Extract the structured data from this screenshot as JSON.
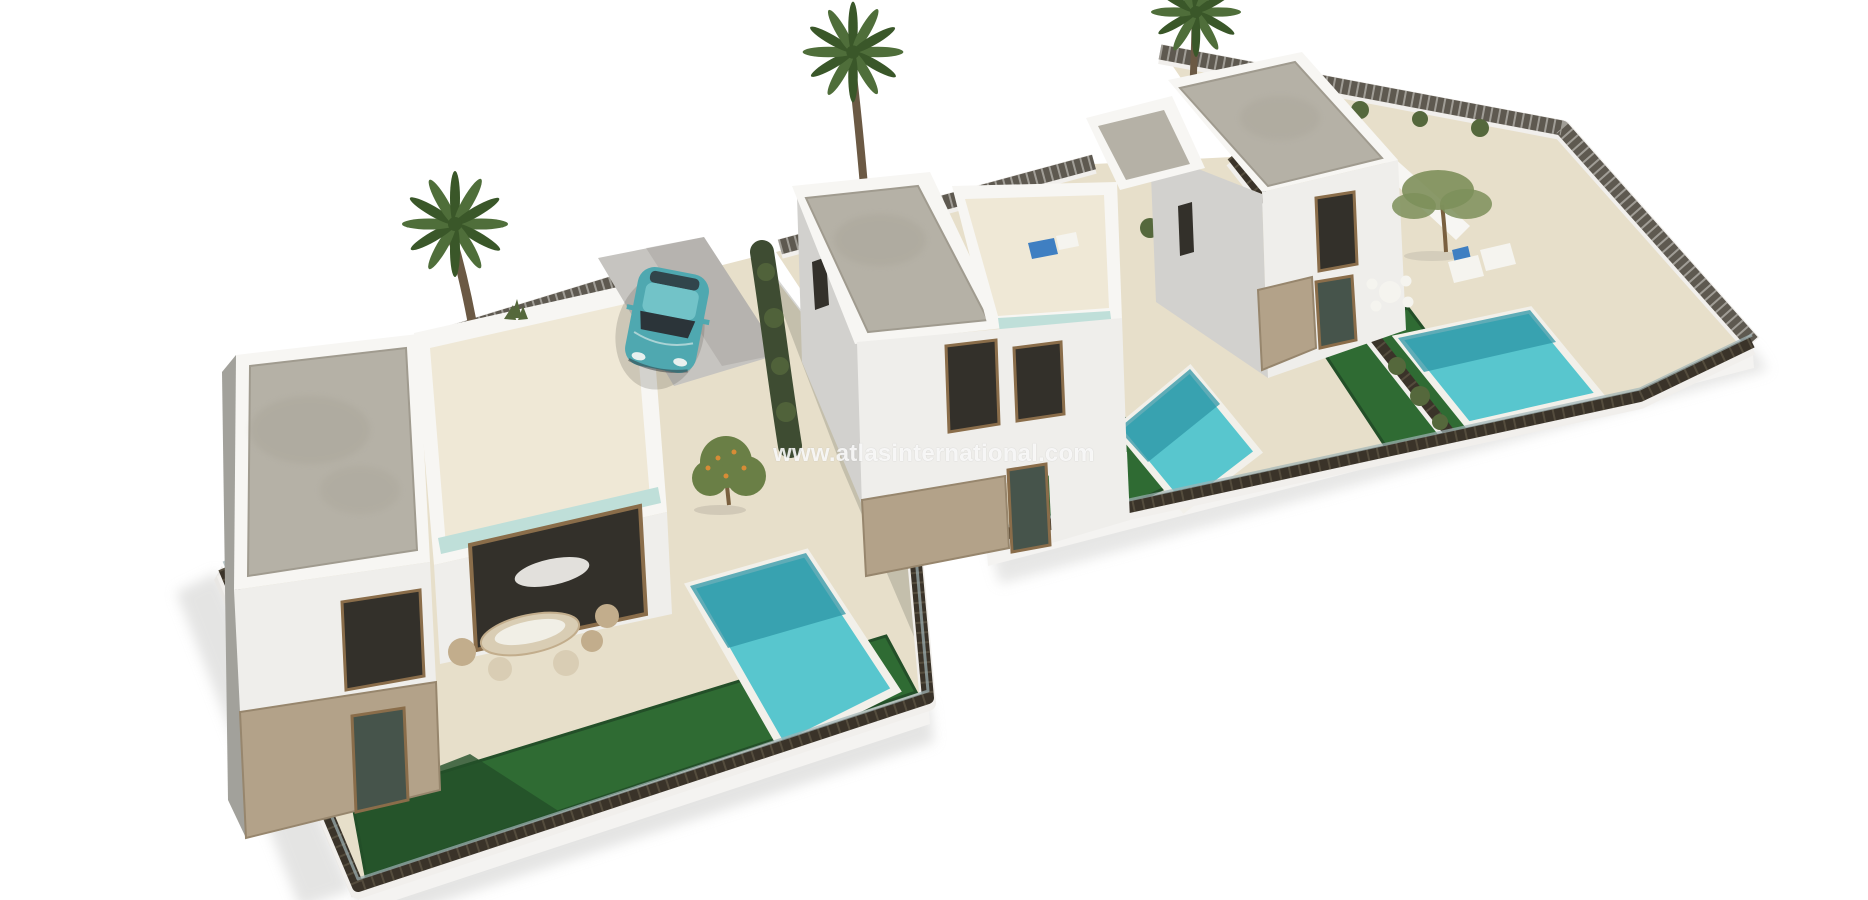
{
  "watermark": {
    "text": "www.atlasinternational.com",
    "color": "#ffffff"
  },
  "scene": {
    "objects": [
      "villa-left",
      "villa-middle",
      "villa-right",
      "pool-left",
      "pool-middle",
      "pool-right",
      "lawn-left",
      "lawn-middle",
      "lawn-right",
      "palm-tree-left",
      "palm-tree-middle",
      "palm-tree-right",
      "parked-car",
      "perimeter-fence",
      "orange-tree",
      "olive-tree",
      "outdoor-furniture",
      "sun-loungers"
    ]
  },
  "colors": {
    "background": "#ffffff",
    "shadow": "#cfcfcd",
    "shadowDark": "#55524b",
    "platform": "#f4f3f1",
    "platformSide": "#e9e7e4",
    "paving": "#e7dfca",
    "pavingLight": "#efe8d6",
    "pavingShade": "#6d6a62",
    "concrete": "#c6c4c0",
    "lawn": "#2f6b33",
    "lawnDark": "#234f28",
    "poolWater": "#58c6ce",
    "poolDeep": "#2d96a6",
    "poolCoping": "#f2f0ea",
    "gravel": "#b5b1a6",
    "gravelDark": "#a09b8f",
    "wallWhite": "#f7f6f3",
    "wallLit": "#efeeeb",
    "wallShade": "#d2d1ce",
    "wallDark": "#a2a19b",
    "stone": "#b3a289",
    "stoneDark": "#97866d",
    "windowDark": "#33302a",
    "windowGlass": "#46544b",
    "windowFrame": "#8a6d4a",
    "glassCyan": "#bfdfd9",
    "fence": "#3a3329",
    "fenceLight": "#6e6552",
    "fenceBase": "#f1efec",
    "fenceAqua": "#9fb4b6",
    "hedge": "#3e4c32",
    "bush": "#55683c",
    "bushYellow": "#a3a94e",
    "palmFrond": "#4f6e3a",
    "palmFrondDark": "#3a5729",
    "palmTrunk": "#6b5944",
    "carBody": "#4fa8b0",
    "carRoof": "#72c3c8",
    "carGlass": "#2b3439",
    "carLight": "#e8f0ef",
    "orangeFoliage": "#6a7f46",
    "orangeFruit": "#d78c36",
    "treeOlive": "#7d8f5a",
    "trunk": "#7a603f",
    "furnCream": "#d9cdb4",
    "furnTan": "#c2ad8c",
    "furnWhite": "#f5f4ef",
    "loungerBlue": "#3f7fc2"
  }
}
